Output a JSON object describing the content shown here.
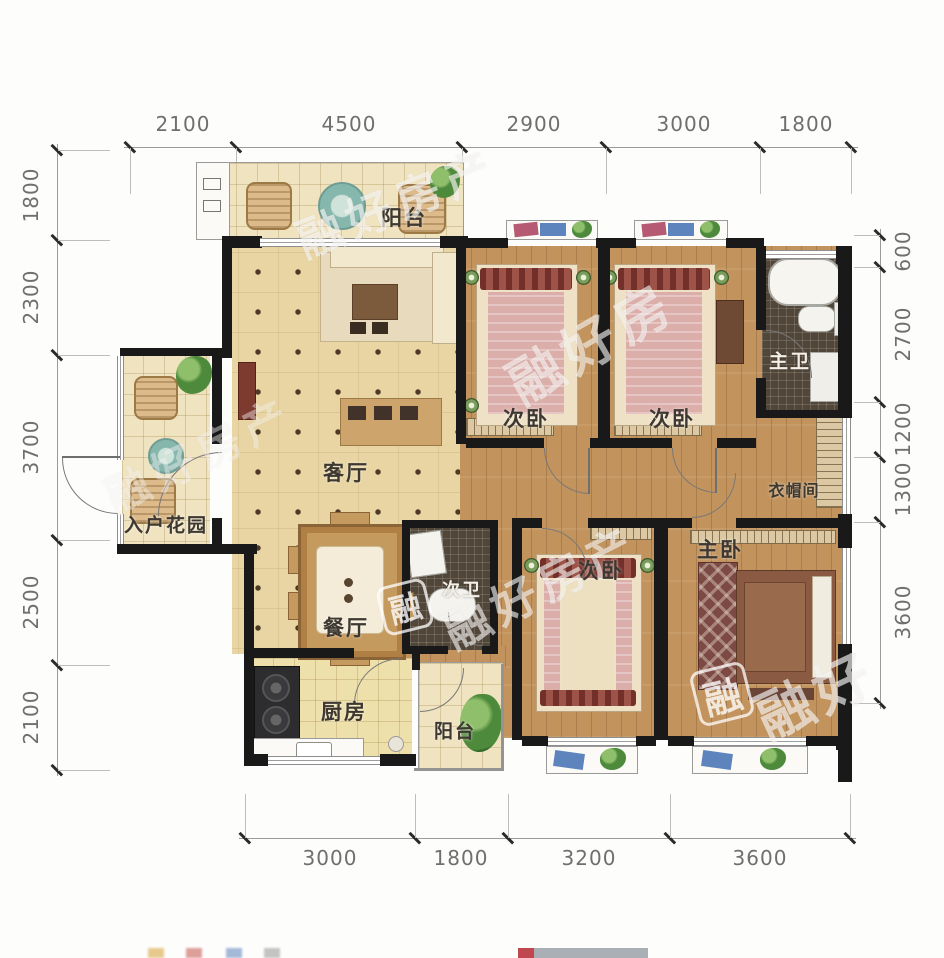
{
  "dimensions": {
    "top": [
      "2100",
      "4500",
      "2900",
      "3000",
      "1800"
    ],
    "left": [
      "1800",
      "2300",
      "3700",
      "2500",
      "2100"
    ],
    "right": [
      "600",
      "2700",
      "1200",
      "1300",
      "3600"
    ],
    "bottom": [
      "3000",
      "1800",
      "3200",
      "3600"
    ]
  },
  "rooms": {
    "balcony_top": "阳台",
    "bedroom_top_left": "次卧",
    "bedroom_top_right": "次卧",
    "master_bathroom": "主卫",
    "living_room": "客厅",
    "entry_garden": "入户花园",
    "dining_room": "餐厅",
    "second_bathroom": "次卫",
    "bedroom_bottom": "次卧",
    "master_bedroom": "主卧",
    "cloakroom": "衣帽间",
    "kitchen": "厨房",
    "balcony_bottom": "阳台"
  },
  "watermarks": {
    "brand_full": "融好房产",
    "brand_three": "融好房",
    "brand_short": "融好",
    "logo_char": "融"
  },
  "colors": {
    "wall": "#191919",
    "wood_floor": "#c2935d",
    "tile_floor": "#e9d5a3",
    "bath_tile": "#51463a",
    "dimension_text": "#6f6f6f",
    "label_text": "#3d3831"
  }
}
